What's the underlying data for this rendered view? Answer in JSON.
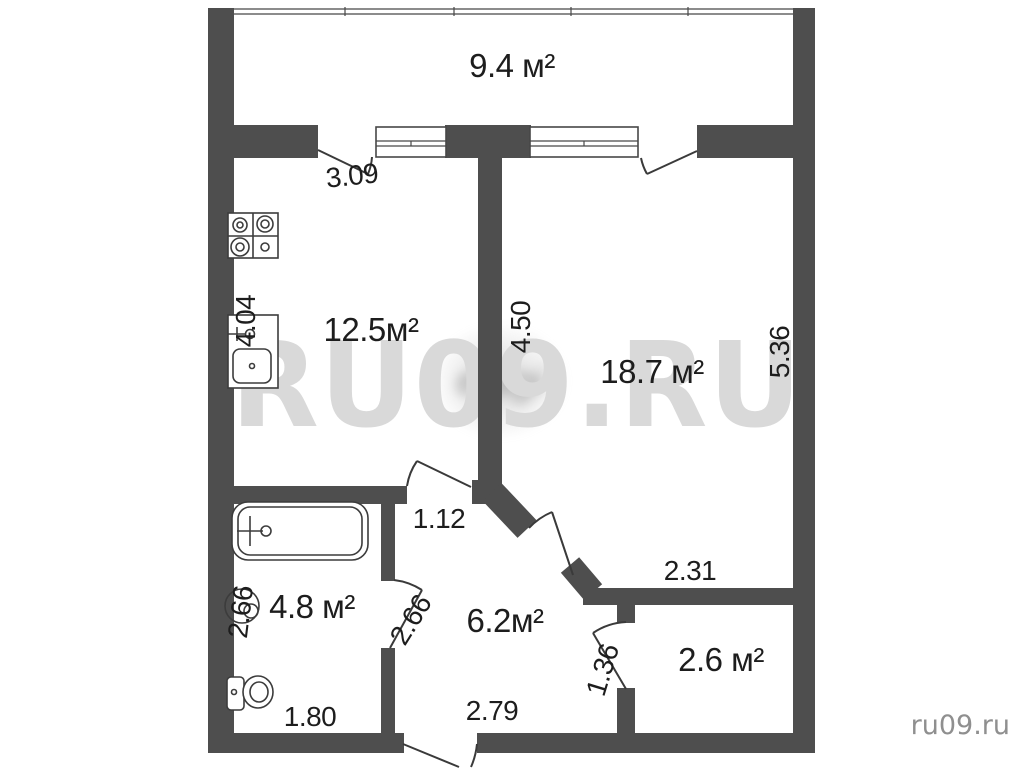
{
  "plan": {
    "watermark_large": "RU09.RU",
    "watermark_small": "ru09.ru",
    "blurred_logo_text": "etagi"
  },
  "rooms": {
    "balcony": {
      "area": "9.4 м²"
    },
    "kitchen": {
      "area": "12.5м²"
    },
    "living_room": {
      "area": "18.7 м²"
    },
    "bathroom": {
      "area": "4.8 м²"
    },
    "hallway": {
      "area": "6.2м²"
    },
    "storage": {
      "area": "2.6 м²"
    }
  },
  "dimensions": {
    "balcony_door_width": "3.09",
    "kitchen_depth": "4.04",
    "living_room_left": "4.50",
    "living_room_right": "5.36",
    "kitchen_door": "1.12",
    "bathroom_left": "2.66",
    "bathroom_door": "2.66",
    "bathroom_width": "1.80",
    "hallway_width": "2.79",
    "storage_door": "1.36",
    "storage_width": "2.31"
  },
  "icons": {
    "stove": "stove-icon",
    "kitchen_sink": "kitchen-sink-icon",
    "bathtub": "bathtub-icon",
    "washing_machine": "washing-machine-icon",
    "toilet": "toilet-icon"
  },
  "colors": {
    "wall": "#4e4e4e",
    "line": "#3a3a3a",
    "text": "#1d1d1d",
    "watermark": "#d9d9d9",
    "site_text": "#8f8f8f",
    "background": "#ffffff"
  }
}
